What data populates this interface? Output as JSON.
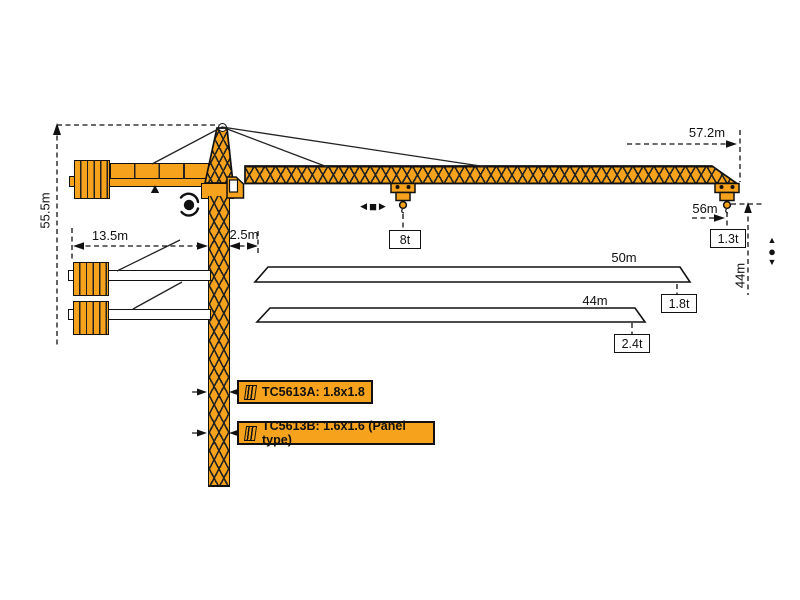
{
  "diagram": {
    "colors": {
      "crane_orange": "#F6A21C",
      "line": "#111111"
    },
    "dimensions": {
      "tower_height": "55.5m",
      "counter_jib_length": "13.5m",
      "rear_slew_radius": "2.5m",
      "jib_tip_radius": "57.2m",
      "max_hook_radius": "56m",
      "lifting_height": "44m"
    },
    "loads": {
      "max_load": "8t",
      "tip_load_57": "1.3t"
    },
    "jib_options": [
      {
        "length": "50m",
        "tip_load": "1.8t"
      },
      {
        "length": "44m",
        "tip_load": "2.4t"
      }
    ],
    "mast_variants": [
      {
        "label": "TC5613A:  1.8x1.8"
      },
      {
        "label": "TC5613B:  1.6x1.6 (Panel type)"
      }
    ],
    "symbols": {
      "trolley_left": "◀",
      "trolley_square": "■",
      "trolley_right": "▶",
      "hoist_up": "▲",
      "hoist_dot": "●",
      "hoist_down": "▼"
    }
  }
}
